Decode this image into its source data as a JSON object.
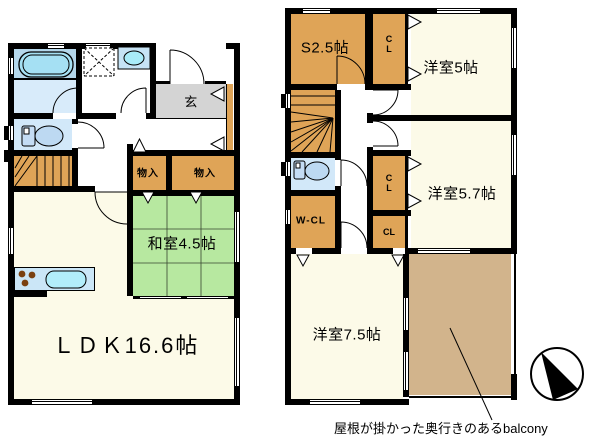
{
  "plan": {
    "floor1": {
      "entrance": "玄",
      "storage_a": "物入",
      "storage_b": "物入",
      "tatami_room": "和室4.5帖",
      "ldk": "ＬＤＫ16.6帖"
    },
    "floor2": {
      "service_room": "S2.5帖",
      "closet_top": "CL",
      "bedroom_5": "洋室5帖",
      "closet_mid": "CL",
      "bedroom_5_7": "洋室5.7帖",
      "closet_low": "CL",
      "walk_in_closet": "W-CL",
      "bedroom_7_5": "洋室7.5帖",
      "balcony_note": "屋根が掛かった奥行きのあるbalcony"
    },
    "colors": {
      "wall": "#000000",
      "room_cream": "#fcfae8",
      "tatami_green": "#b7e8a0",
      "storage_orange": "#dfa457",
      "balcony_tan": "#d2b48c",
      "bath_blue": "#b4d7eb",
      "washroom_blue": "#d8ebfa",
      "water_blue": "#d2e8f9",
      "entrance_gray": "#d4d4d4",
      "fixture_blue": "#a5e0f3"
    },
    "icons": {
      "compass": "north-arrow-compass",
      "bathtub": "bathtub",
      "toilet_1f": "toilet",
      "toilet_2f": "toilet",
      "washbasin": "washbasin",
      "laundry_space": "washer-space-dashed",
      "stove": "stove-burners",
      "kitchen_sink": "kitchen-sink",
      "stairs_1f": "winder-stairs",
      "stairs_2f": "winder-stairs",
      "doors": "door-swing-arc",
      "closet_doors": "folding-door-marker"
    }
  }
}
